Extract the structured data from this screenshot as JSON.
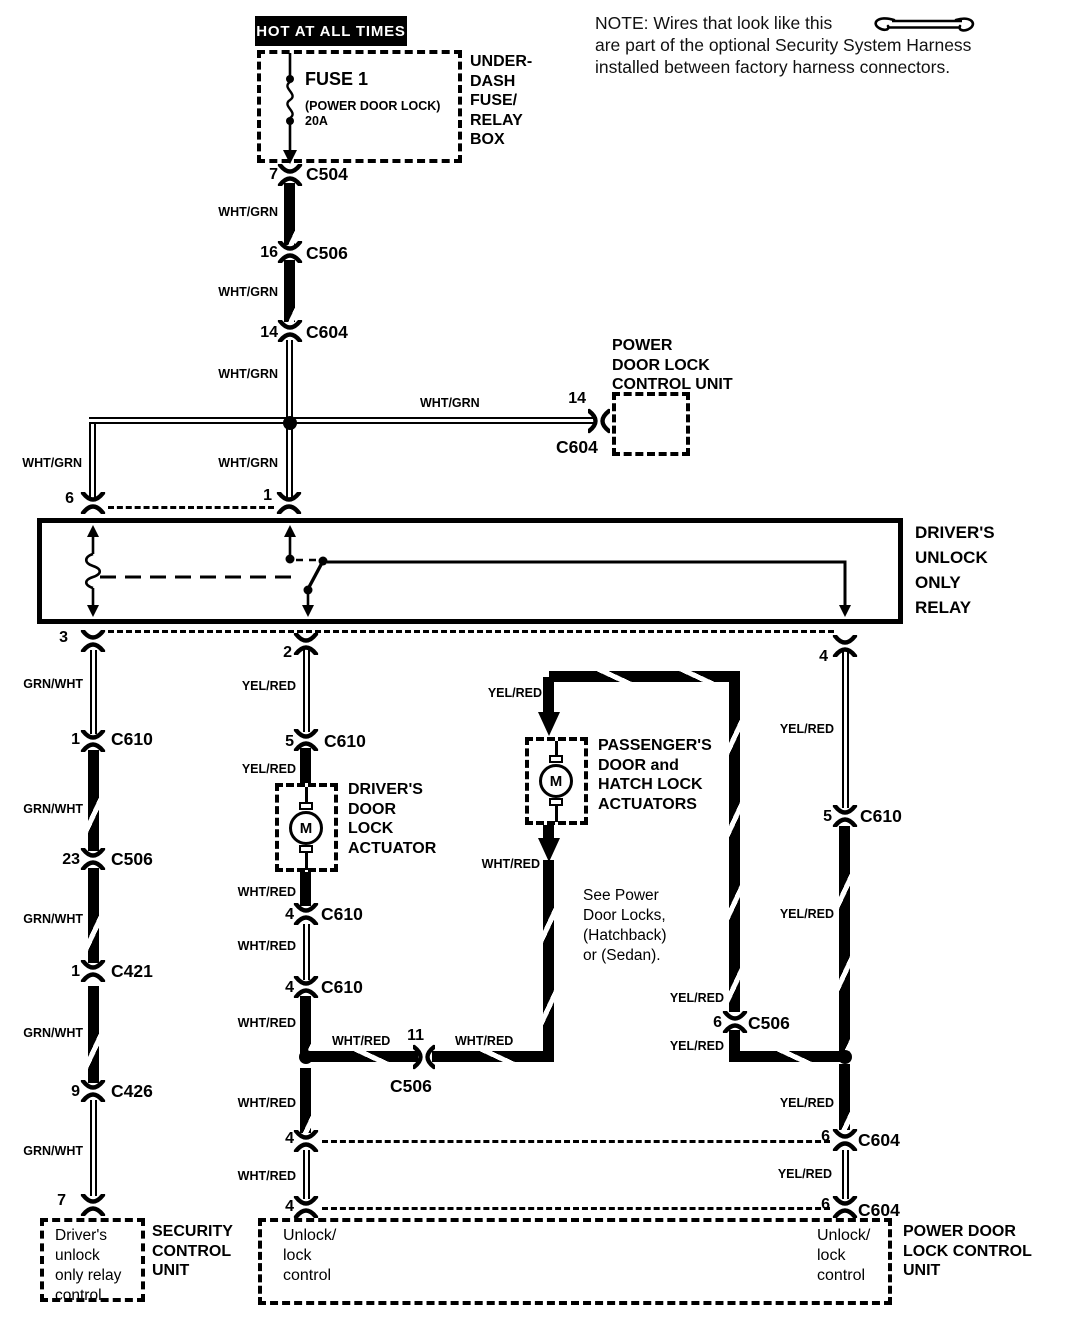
{
  "note": {
    "line1": "NOTE: Wires that look like this",
    "rest": "are part of the optional Security System Harness\ninstalled between factory harness connectors."
  },
  "wire_colors": {
    "wht_grn": "WHT/GRN",
    "grn_wht": "GRN/WHT",
    "yel_red": "YEL/RED",
    "wht_red": "WHT/RED"
  },
  "power": {
    "hot": "HOT AT ALL TIMES",
    "fuse_name": "FUSE 1",
    "fuse_desc": "(POWER DOOR LOCK)",
    "fuse_rating": "20A",
    "box_label": "UNDER-\nDASH\nFUSE/\nRELAY\nBOX"
  },
  "conn": {
    "c504": {
      "pin": "7",
      "name": "C504"
    },
    "c506_16": {
      "pin": "16",
      "name": "C506"
    },
    "c604_14": {
      "pin": "14",
      "name": "C604"
    },
    "c610_1": {
      "pin": "1",
      "name": "C610"
    },
    "c506_23": {
      "pin": "23",
      "name": "C506"
    },
    "c421_1": {
      "pin": "1",
      "name": "C421"
    },
    "c426_9": {
      "pin": "9",
      "name": "C426"
    },
    "c610_5": {
      "pin": "5",
      "name": "C610"
    },
    "c610_4a": {
      "pin": "4",
      "name": "C610"
    },
    "c610_4b": {
      "pin": "4",
      "name": "C610"
    },
    "c506_11": {
      "pin": "11",
      "name": "C506"
    },
    "c610_5r": {
      "pin": "5",
      "name": "C610"
    },
    "c506_6": {
      "pin": "6",
      "name": "C506"
    },
    "c604_6a": {
      "pin": "6",
      "name": "C604"
    },
    "c604_6b": {
      "pin": "6",
      "name": "C604"
    }
  },
  "pdlcu_top": {
    "label": "POWER\nDOOR LOCK\nCONTROL UNIT",
    "pin": "14",
    "connector": "C604"
  },
  "relay": {
    "label": "DRIVER'S\nUNLOCK\nONLY\nRELAY",
    "pins": {
      "p6": "6",
      "p1": "1",
      "p3": "3",
      "p2": "2",
      "p4": "4"
    }
  },
  "driver_actuator": {
    "label": "DRIVER'S\nDOOR\nLOCK\nACTUATOR",
    "motor": "M"
  },
  "passenger_actuator": {
    "label": "PASSENGER'S\nDOOR and\nHATCH LOCK\nACTUATORS",
    "motor": "M",
    "see_note": "See Power\nDoor Locks,\n(Hatchback)\nor (Sedan)."
  },
  "scu": {
    "pin": "7",
    "box_text": "Driver's\nunlock\nonly relay\ncontrol",
    "label": "SECURITY\nCONTROL\nUNIT"
  },
  "pdlcu_bottom": {
    "label": "POWER DOOR\nLOCK CONTROL\nUNIT",
    "unlock_left": "Unlock/\nlock\ncontrol",
    "unlock_right": "Unlock/\nlock\ncontrol",
    "pin_4a": "4",
    "pin_4b": "4"
  }
}
